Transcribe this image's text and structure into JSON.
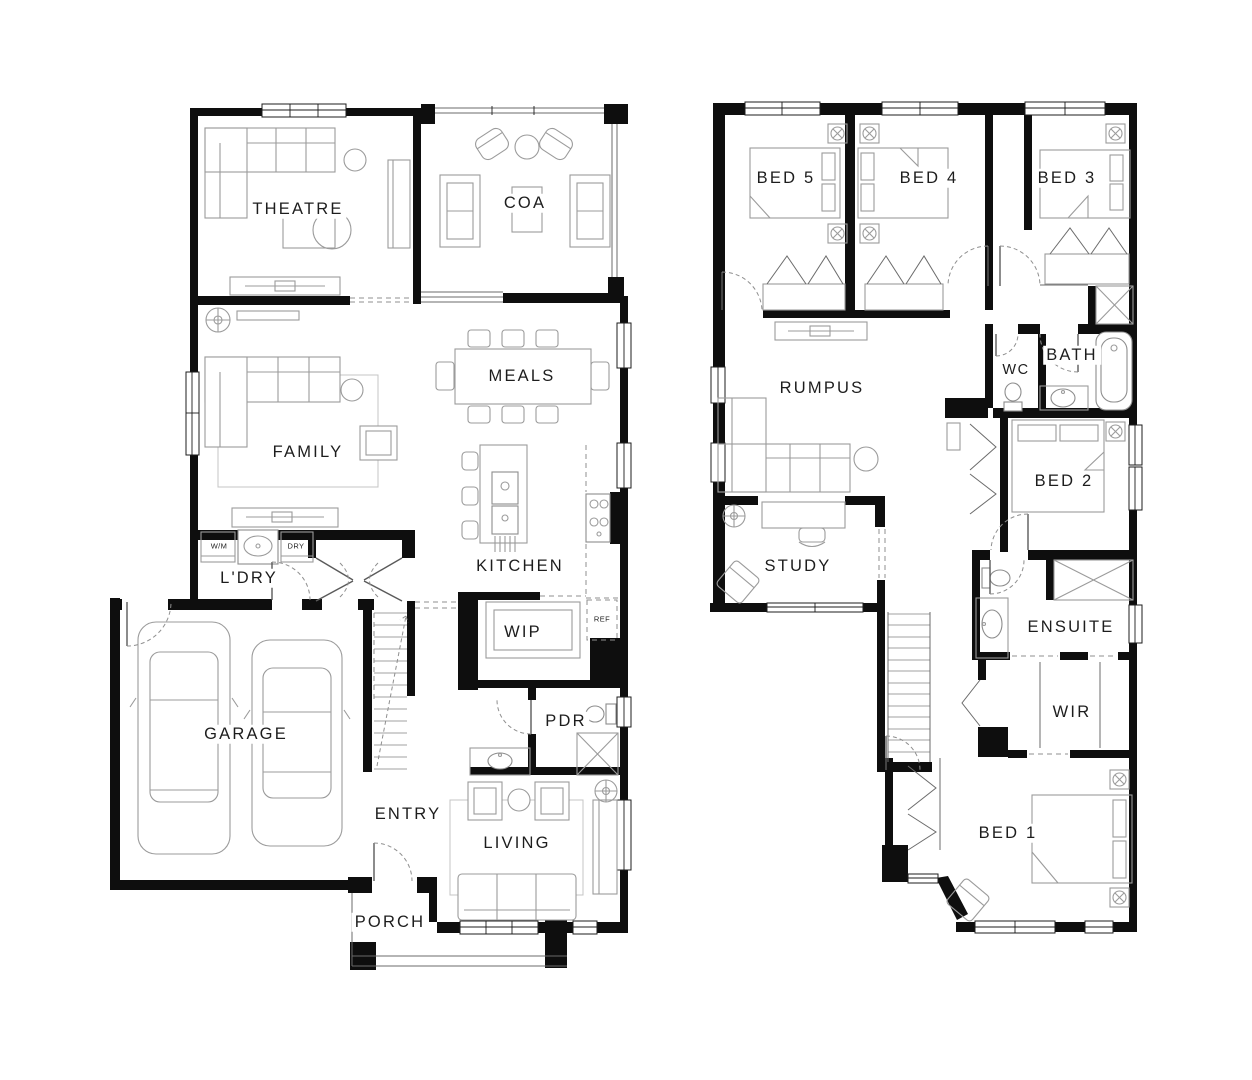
{
  "document": {
    "kind": "house-floor-plan",
    "background": "#ffffff",
    "line_color": "#0e0e0e"
  },
  "ground_floor": {
    "rooms": [
      {
        "id": "theatre",
        "label": "THEATRE"
      },
      {
        "id": "coa",
        "label": "COA"
      },
      {
        "id": "meals",
        "label": "MEALS"
      },
      {
        "id": "family",
        "label": "FAMILY"
      },
      {
        "id": "kitchen",
        "label": "KITCHEN"
      },
      {
        "id": "laundry",
        "label": "L'DRY"
      },
      {
        "id": "wip",
        "label": "WIP"
      },
      {
        "id": "pdr",
        "label": "PDR"
      },
      {
        "id": "garage",
        "label": "GARAGE"
      },
      {
        "id": "entry",
        "label": "ENTRY"
      },
      {
        "id": "living",
        "label": "LIVING"
      },
      {
        "id": "porch",
        "label": "PORCH"
      }
    ],
    "appliances": [
      {
        "id": "wm",
        "label": "W/M"
      },
      {
        "id": "dry",
        "label": "DRY"
      },
      {
        "id": "ref",
        "label": "REF"
      }
    ]
  },
  "first_floor": {
    "rooms": [
      {
        "id": "bed5",
        "label": "BED 5"
      },
      {
        "id": "bed4",
        "label": "BED 4"
      },
      {
        "id": "bed3",
        "label": "BED 3"
      },
      {
        "id": "rumpus",
        "label": "RUMPUS"
      },
      {
        "id": "wc",
        "label": "WC"
      },
      {
        "id": "bath",
        "label": "BATH"
      },
      {
        "id": "bed2",
        "label": "BED 2"
      },
      {
        "id": "study",
        "label": "STUDY"
      },
      {
        "id": "ensuite",
        "label": "ENSUITE"
      },
      {
        "id": "wir",
        "label": "WIR"
      },
      {
        "id": "bed1",
        "label": "BED 1"
      }
    ]
  }
}
